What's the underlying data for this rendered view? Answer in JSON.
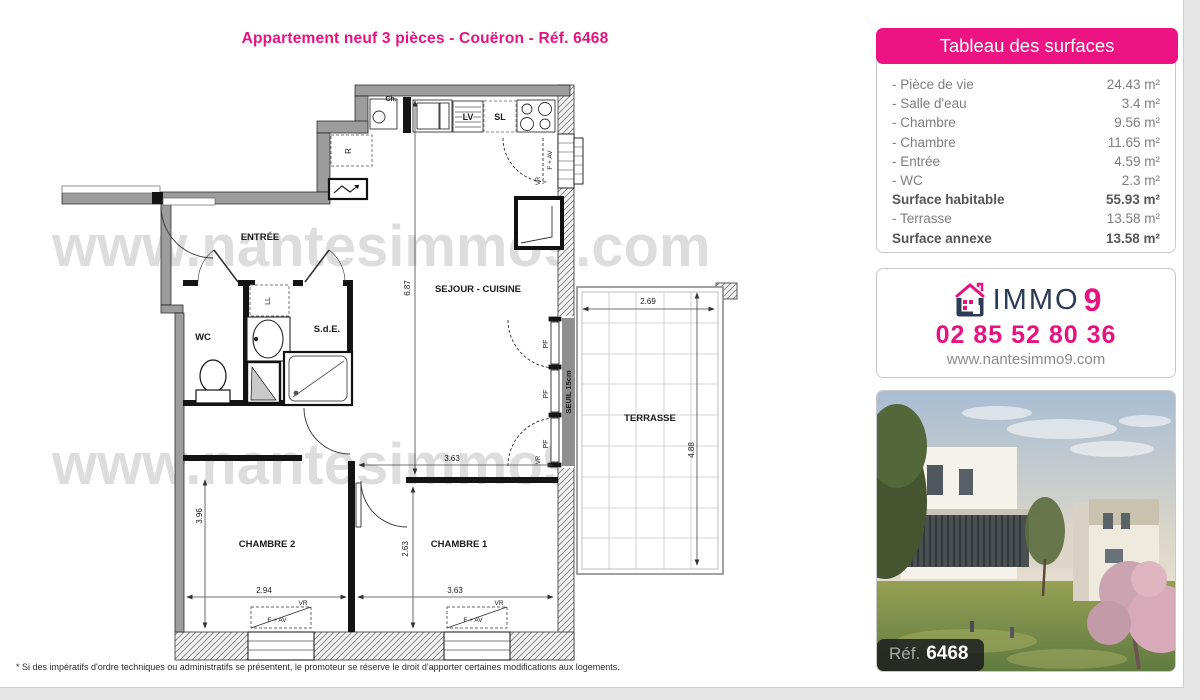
{
  "page": {
    "title": "Appartement neuf 3 pièces - Couëron - Réf. 6468",
    "footnote": "* Si des impératifs d'ordre techniques ou administratifs se présentent, le promoteur se réserve le droit d'apporter certaines modifications aux logements.",
    "watermark": "www.nantesimmo9.com",
    "accent_color": "#e5127f",
    "navy_color": "#2b3a55"
  },
  "surfaces": {
    "header": "Tableau des surfaces",
    "rows": [
      {
        "label": "- Pièce de vie",
        "value": "24.43 m²"
      },
      {
        "label": "- Salle d'eau",
        "value": "3.4 m²"
      },
      {
        "label": "- Chambre",
        "value": "9.56 m²"
      },
      {
        "label": "- Chambre",
        "value": "11.65 m²"
      },
      {
        "label": "- Entrée",
        "value": "4.59 m²"
      },
      {
        "label": "- WC",
        "value": "2.3 m²"
      },
      {
        "label": "Surface habitable",
        "value": "55.93 m²"
      },
      {
        "label": "- Terrasse",
        "value": "13.58 m²"
      },
      {
        "label": "Surface annexe",
        "value": "13.58 m²"
      }
    ]
  },
  "agency": {
    "brand_immo": "IMMO",
    "brand_9": "9",
    "phone": "02 85 52 80 36",
    "website": "www.nantesimmo9.com"
  },
  "photo": {
    "ref_label": "Réf.",
    "ref_value": "6468"
  },
  "floorplan": {
    "rooms": {
      "entree": "ENTRÉE",
      "wc": "WC",
      "sde": "S.d.E.",
      "sejour": "SEJOUR - CUISINE",
      "chambre1": "CHAMBRE 1",
      "chambre2": "CHAMBRE 2",
      "terrasse": "TERRASSE"
    },
    "fixtures": {
      "ch": "Ch.",
      "lv": "LV",
      "sl": "SL",
      "r": "R",
      "ll": "LL",
      "seuil": "SEUIL 15cm",
      "pf": "PF",
      "vr": "VR",
      "fav": "F + AV"
    },
    "dims": {
      "sejour_h": "6.87",
      "ch1_top_w": "3.63",
      "ch1_w": "3.63",
      "ch1_h": "2.63",
      "ch2_w": "2.94",
      "ch2_h": "3.96",
      "terrasse_w": "2.69",
      "terrasse_h": "4.88"
    }
  }
}
